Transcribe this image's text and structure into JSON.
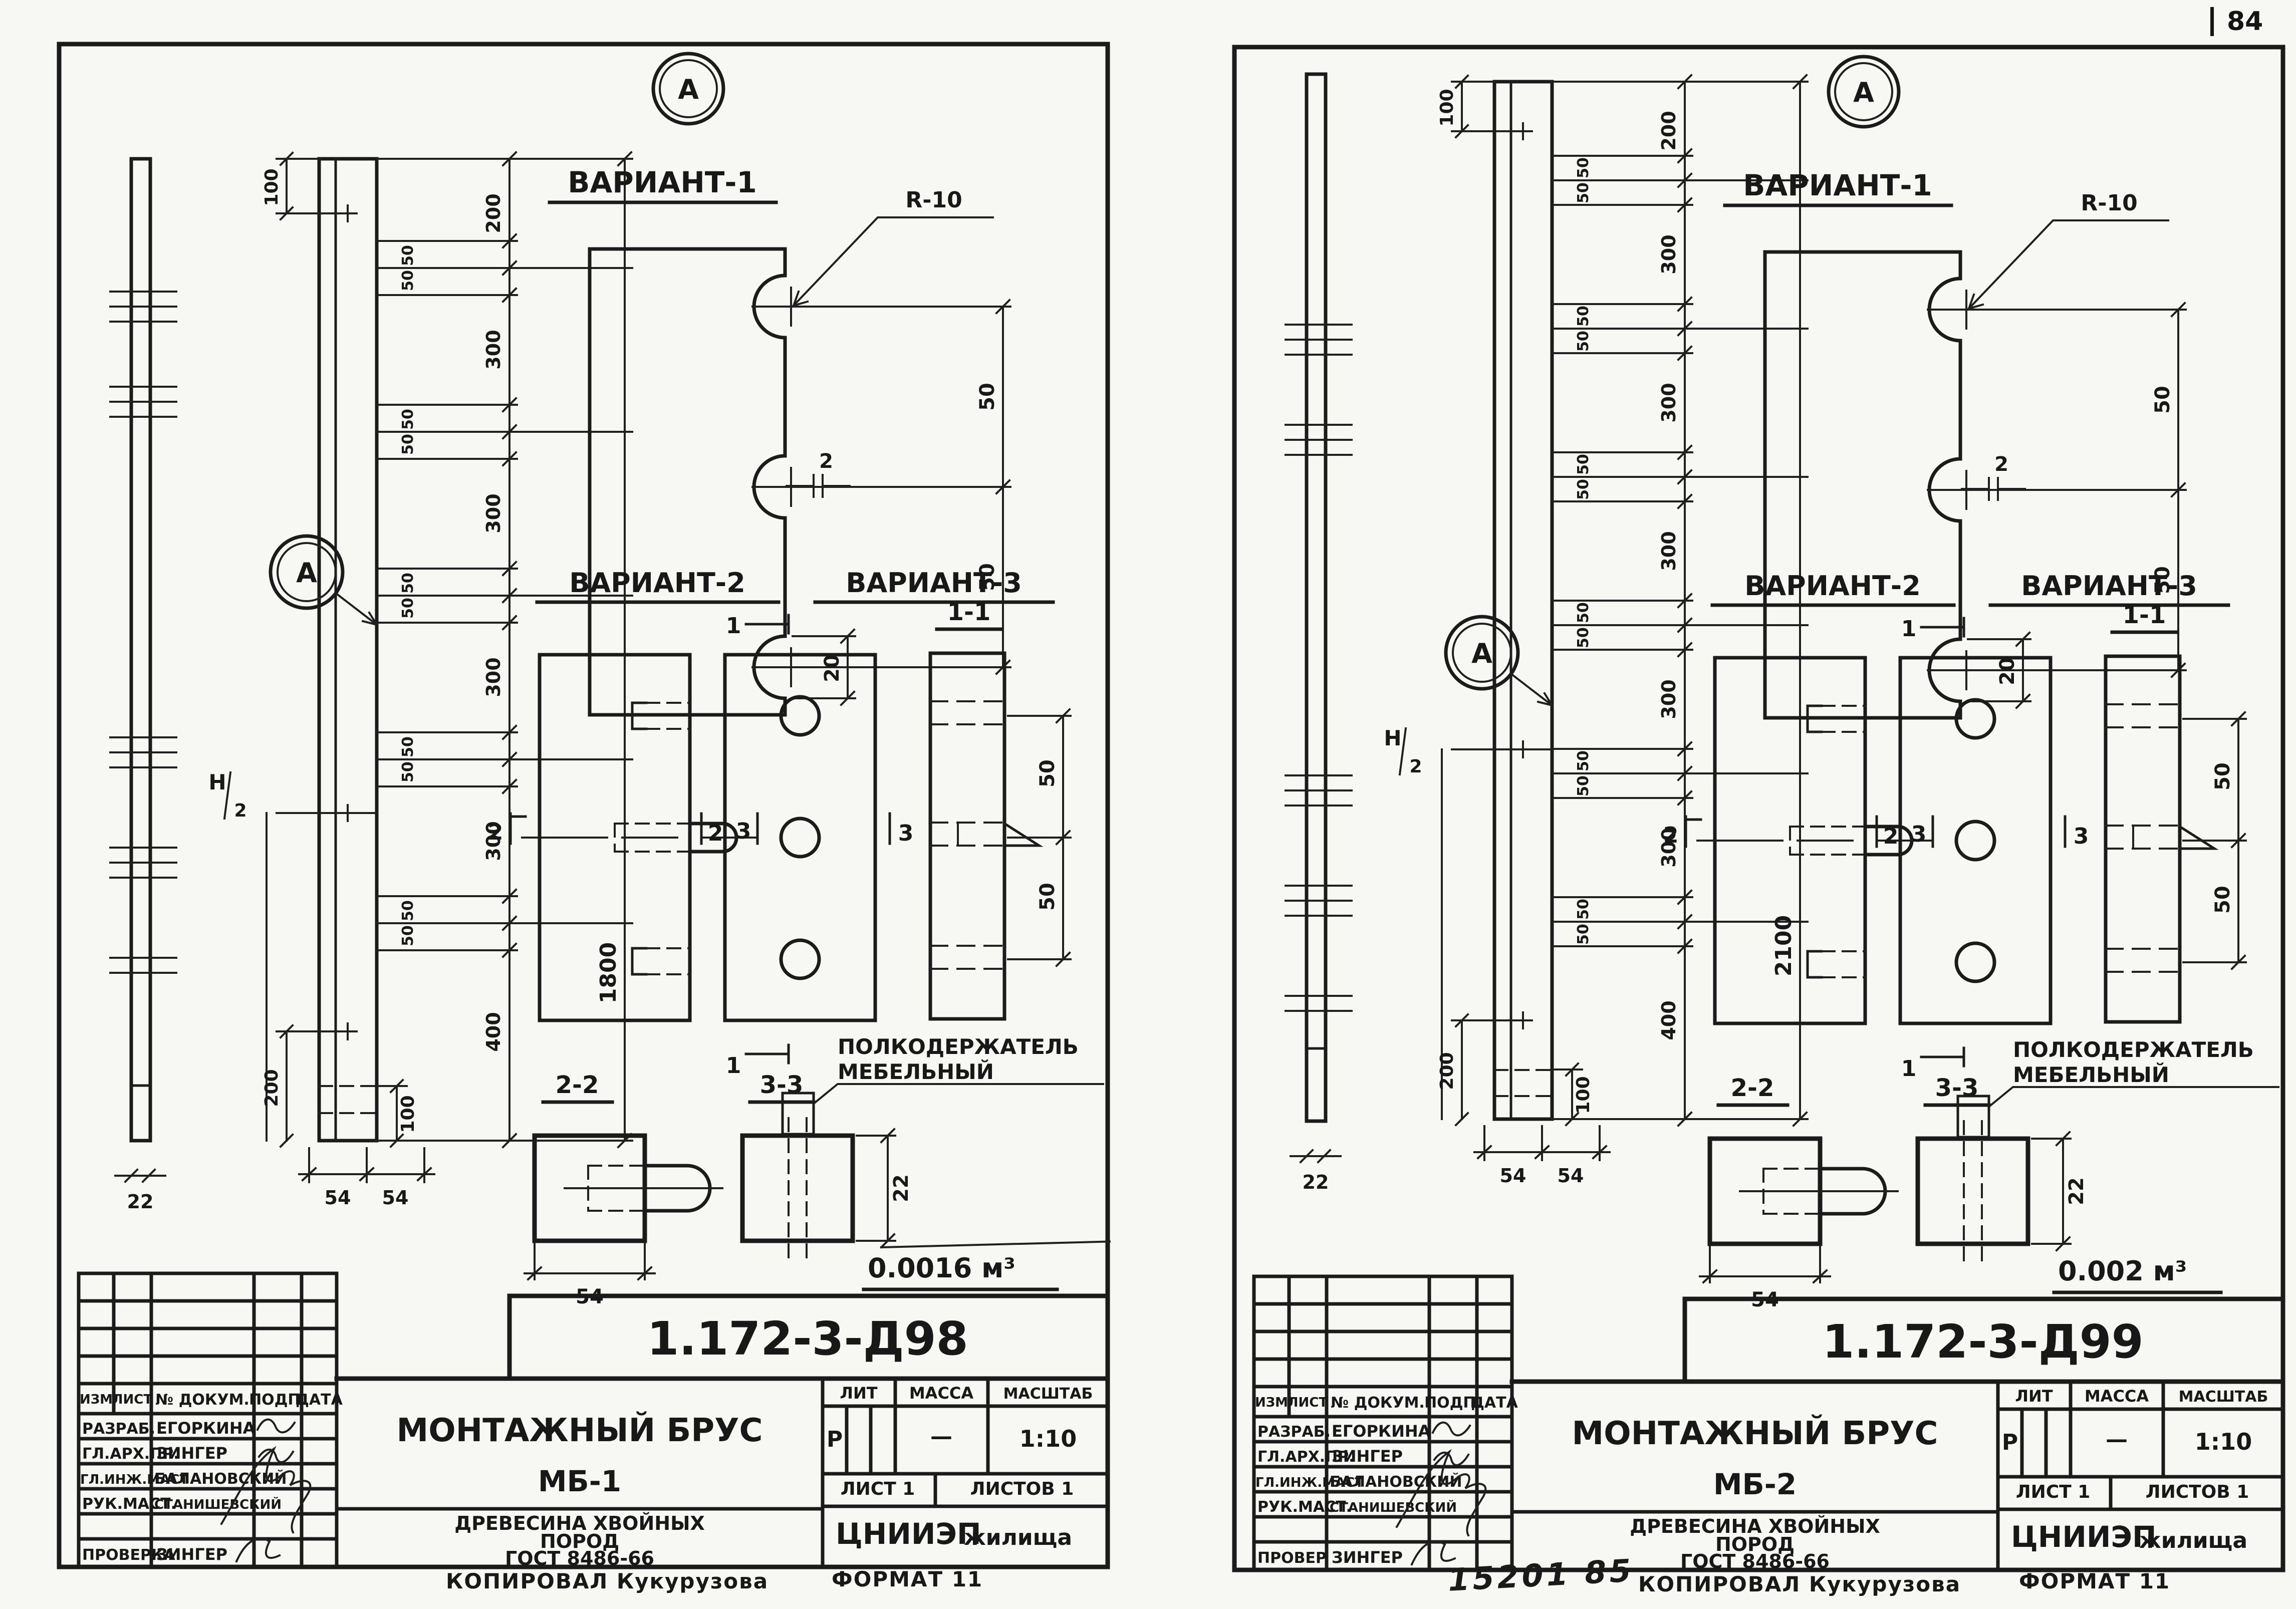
{
  "page": {
    "number": "84"
  },
  "labels": {
    "a": "А",
    "v1": "ВАРИАНТ-1",
    "v2": "ВАРИАНТ-2",
    "v3": "ВАРИАНТ-3",
    "s11": "1-1",
    "s22": "2-2",
    "s33": "3-3",
    "m1": "1",
    "m2": "2",
    "m3": "3",
    "r10": "R-10",
    "h_top": "Н",
    "h_bot": "2",
    "holder1": "ПОЛКОДЕРЖАТЕЛЬ",
    "holder2": "МЕБЕЛЬНЫЙ"
  },
  "dim": {
    "d2": "2",
    "d20": "20",
    "d22": "22",
    "d50": "50",
    "d54": "54",
    "d100": "100",
    "d200": "200",
    "d300": "300",
    "d400": "400"
  },
  "tb": {
    "izm": "ИЗМ",
    "list": "ЛИСТ",
    "doc": "№ ДОКУМ.",
    "sign": "ПОДП.",
    "date": "ДАТА",
    "lit": "ЛИТ",
    "mass": "МАССА",
    "scale": "МАСШТАБ"
  },
  "sheet_left": {
    "doc_no": "1.172-3-Д98",
    "title": "МОНТАЖНЫЙ БРУС",
    "mark": "МБ-1",
    "mat1": "ДРЕВЕСИНА ХВОЙНЫХ",
    "mat2": "ПОРОД",
    "mat3": "ГОСТ 8486-66",
    "lit_val": "Р",
    "mass_val": "—",
    "scale_val": "1:10",
    "sheet_no": "ЛИСТ 1",
    "sheets_total": "ЛИСТОВ 1",
    "org1": "ЦНИИЭП",
    "org2": "жилища",
    "volume": "0.0016 м³",
    "total": "1800",
    "chain": [
      "200",
      "300",
      "300",
      "300",
      "300",
      "400"
    ],
    "rows": [
      {
        "role": "РАЗРАБ.",
        "name": "ЕГОРКИНА"
      },
      {
        "role": "ГЛ.АРХ.ПР.",
        "name": "ЗИНГЕР"
      },
      {
        "role": "ГЛ.ИНЖ.МАСТ",
        "name": "БАЛАНОВСКИЙ"
      },
      {
        "role": "РУК.МАСТ.",
        "name": "СТАНИШЕВСКИЙ"
      },
      {
        "role": "ПРОВЕРКА",
        "name": "ЗИНГЕР"
      }
    ],
    "foot_copy": "КОПИРОВАЛ Кукурузова",
    "foot_format": "ФОРМАТ 11"
  },
  "sheet_right": {
    "doc_no": "1.172-3-Д99",
    "title": "МОНТАЖНЫЙ БРУС",
    "mark": "МБ-2",
    "mat1": "ДРЕВЕСИНА ХВОЙНЫХ",
    "mat2": "ПОРОД",
    "mat3": "ГОСТ 8486-66",
    "lit_val": "Р",
    "mass_val": "—",
    "scale_val": "1:10",
    "sheet_no": "ЛИСТ 1",
    "sheets_total": "ЛИСТОВ 1",
    "org1": "ЦНИИЭП",
    "org2": "жилища",
    "volume": "0.002 м³",
    "total": "2100",
    "chain": [
      "200",
      "300",
      "300",
      "300",
      "300",
      "300",
      "400"
    ],
    "rows": [
      {
        "role": "РАЗРАБ.",
        "name": "ЕГОРКИНА"
      },
      {
        "role": "ГЛ.АРХ.ПР.",
        "name": "ЗИНГЕР"
      },
      {
        "role": "ГЛ.ИНЖ.МАСТ",
        "name": "БАЛАНОВСКИЙ"
      },
      {
        "role": "РУК.МАСТ.",
        "name": "СТАНИШЕВСКИЙ"
      },
      {
        "role": "ПРОВЕР",
        "name": "ЗИНГЕР"
      }
    ],
    "stamp": "15201 85",
    "foot_copy": "КОПИРОВАЛ Кукурузова",
    "foot_format": "ФОРМАТ 11"
  }
}
